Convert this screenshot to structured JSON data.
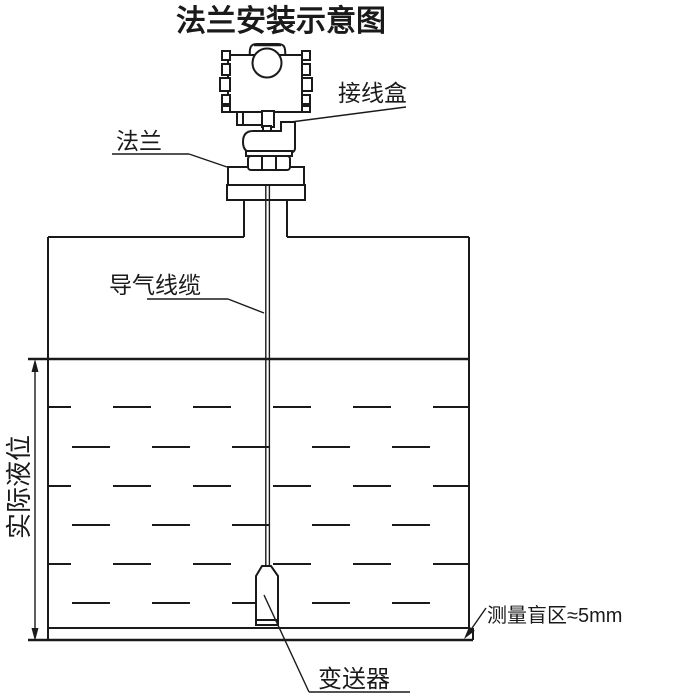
{
  "title": "法兰安装示意图",
  "labels": {
    "junction_box": "接线盒",
    "flange": "法兰",
    "air_cable": "导气线缆",
    "actual_level": "实际液位",
    "transmitter": "变送器",
    "blind_zone": "测量盲区≈5mm"
  },
  "colors": {
    "line": "#1a1a1a",
    "background": "#ffffff"
  }
}
